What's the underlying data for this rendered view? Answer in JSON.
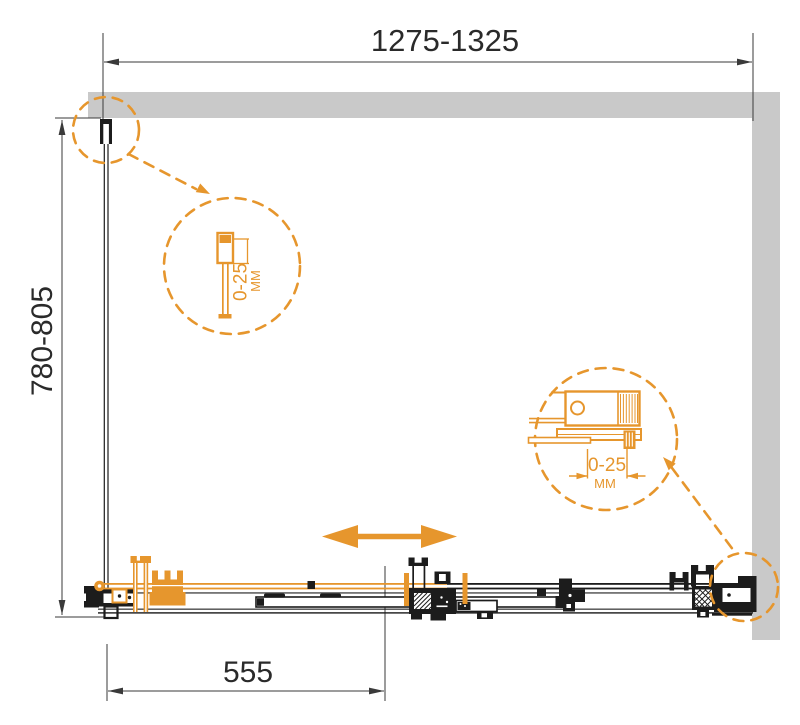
{
  "diagram": {
    "dimensions": {
      "width_range": "1275-1325",
      "depth_range": "780-805",
      "door_travel": "555"
    },
    "detail_wall_profile": {
      "range": "0-25",
      "unit": "ММ"
    },
    "detail_door_profile": {
      "range": "0-25",
      "unit": "ММ"
    },
    "colors": {
      "accent_orange": "#e6962d",
      "wall_gray": "#c9c9c9",
      "ink_black": "#1c1c1c"
    }
  }
}
